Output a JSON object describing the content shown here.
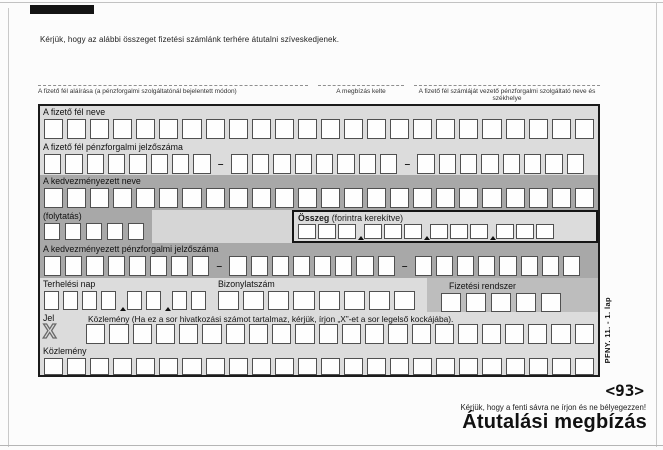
{
  "page": {
    "intro": "Kérjük, hogy az alábbi összeget fizetési számlánk terhére átutalni szíveskedjenek.",
    "signature_label": "A fizető fél aláírása (a pénzforgalmi szolgáltatónál bejelentett módon)",
    "date_label": "A megbízás kelte",
    "bank_label": "A fizető fél számláját vezető pénzforgalmi szolgáltató neve és székhelye",
    "form_code_vertical": "PFNY. 11.  - 1. lap",
    "ocr_code": "<93>",
    "band_note": "Kérjük, hogy a fenti sávra ne írjon és ne bélyegezzen!",
    "title": "Átutalási megbízás"
  },
  "form": {
    "payer_name": {
      "label": "A fizető fél neve",
      "cells": 24
    },
    "payer_account": {
      "label": "A fizető fél pénzforgalmi jelzőszáma",
      "groups": [
        8,
        8,
        8
      ],
      "separator": "–"
    },
    "beneficiary_name": {
      "label": "A kedvezményezett neve",
      "cells": 24
    },
    "continuation": {
      "label": "(folytatás)",
      "cells": 5
    },
    "amount": {
      "label_bold": "Összeg",
      "label_rest": " (forintra kerekítve)",
      "cells": 12,
      "currency": "Ft"
    },
    "beneficiary_account": {
      "label": "A kedvezményezett pénzforgalmi jelzőszáma",
      "groups": [
        8,
        8,
        8
      ],
      "separator": "–"
    },
    "debit_day": {
      "label": "Terhelési nap",
      "cells": 8
    },
    "voucher_number": {
      "label": "Bizonylatszám",
      "cells": 8
    },
    "payment_system": {
      "label": "Fizetési rendszer",
      "cells": 5
    },
    "flag": {
      "label": "Jel",
      "mark": "X"
    },
    "remittance1": {
      "label": "Közlemény (Ha ez a sor hivatkozási számot tartalmaz, kérjük, írjon „X”-et a sor legelső kockájába).",
      "cells": 22
    },
    "remittance2": {
      "label": "Közlemény",
      "cells": 24
    }
  },
  "colors": {
    "band_light": "#dcdcdc",
    "band_dark": "#a8a8a8",
    "payment_system_band": "#bdbdbd",
    "cell_border": "#505050",
    "form_border": "#1b1b1b",
    "registration_mark": "#141414"
  }
}
